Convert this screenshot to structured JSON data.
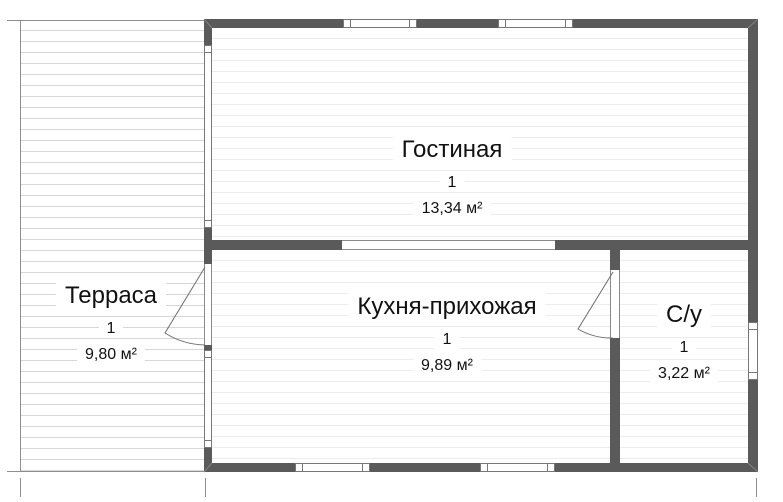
{
  "plan_title": "floor-plan",
  "rooms": [
    {
      "id": "terrace",
      "name": "Терраса",
      "number": "1",
      "area": "9,80 м²"
    },
    {
      "id": "living-room",
      "name": "Гостиная",
      "number": "1",
      "area": "13,34 м²"
    },
    {
      "id": "kitchen-hall",
      "name": "Кухня-прихожая",
      "number": "1",
      "area": "9,89 м²"
    },
    {
      "id": "bathroom",
      "name": "С/у",
      "number": "1",
      "area": "3,22 м²"
    }
  ],
  "colors": {
    "wall": "#5a5a5a",
    "outline": "#8f8f8f",
    "interior_floor_line": "#ececec",
    "terrace_floor_line": "#d7d7d7",
    "text": "#111111",
    "background": "#ffffff"
  }
}
